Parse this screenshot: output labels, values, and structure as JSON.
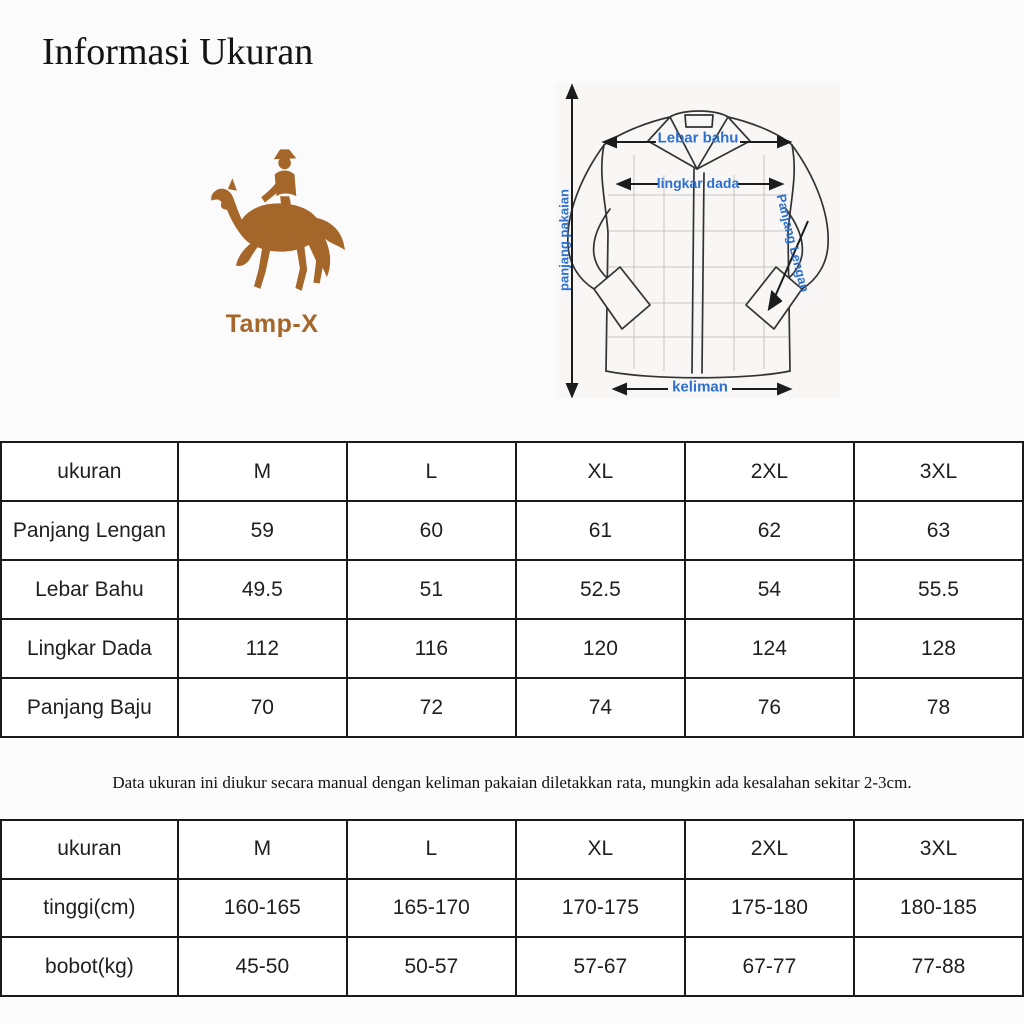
{
  "page": {
    "title": "Informasi Ukuran",
    "note": "Data ukuran ini diukur secara manual dengan keliman pakaian diletakkan rata, mungkin ada kesalahan sekitar 2-3cm.",
    "background_color": "#fcfbfb"
  },
  "brand": {
    "name": "Tamp-X",
    "logo_icon": "horse-rider-logo",
    "color": "#a5662a"
  },
  "diagram": {
    "label_color": "#2e70d2",
    "labels": {
      "shoulder_width": "Lebar bahu",
      "chest_circumference": "lingkar dada",
      "garment_length": "panjang pakaian",
      "sleeve_length": "Panjang Lengan",
      "hem": "keliman"
    }
  },
  "size_table": {
    "headers": [
      "ukuran",
      "M",
      "L",
      "XL",
      "2XL",
      "3XL"
    ],
    "rows": [
      {
        "label": "Panjang Lengan",
        "values": [
          "59",
          "60",
          "61",
          "62",
          "63"
        ]
      },
      {
        "label": "Lebar Bahu",
        "values": [
          "49.5",
          "51",
          "52.5",
          "54",
          "55.5"
        ]
      },
      {
        "label": "Lingkar Dada",
        "values": [
          "112",
          "116",
          "120",
          "124",
          "128"
        ]
      },
      {
        "label": "Panjang Baju",
        "values": [
          "70",
          "72",
          "74",
          "76",
          "78"
        ]
      }
    ]
  },
  "fit_table": {
    "headers": [
      "ukuran",
      "M",
      "L",
      "XL",
      "2XL",
      "3XL"
    ],
    "rows": [
      {
        "label": "tinggi(cm)",
        "values": [
          "160-165",
          "165-170",
          "170-175",
          "175-180",
          "180-185"
        ]
      },
      {
        "label": "bobot(kg)",
        "values": [
          "45-50",
          "50-57",
          "57-67",
          "67-77",
          "77-88"
        ]
      }
    ]
  }
}
